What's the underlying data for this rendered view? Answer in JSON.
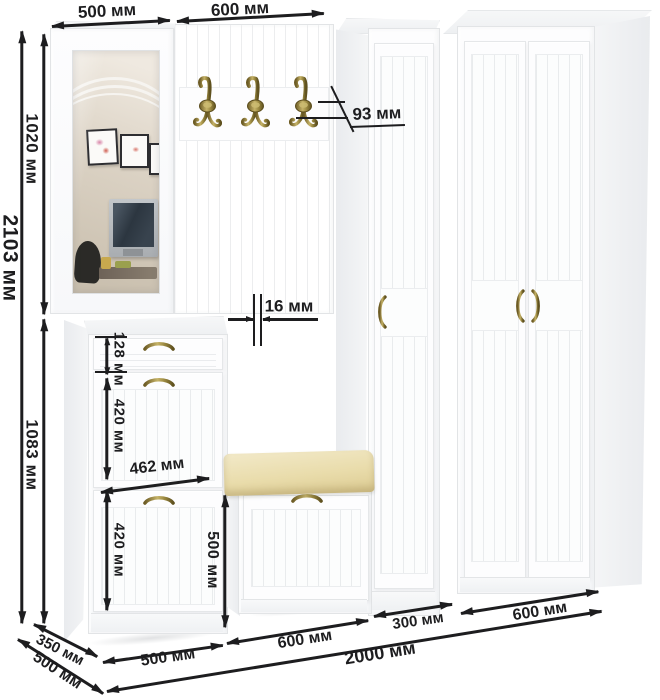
{
  "diagram": {
    "unit": "мм",
    "ink_color": "#1d1d1f",
    "brass_color": "#8d7a3c",
    "cushion_color": "#e9dcab",
    "furniture_color": "#fcfcfd"
  },
  "labels": {
    "mirror_width": "500 мм",
    "hook_panel_width": "600 мм",
    "total_height": "2103 мм",
    "upper_height": "1020 мм",
    "lower_height": "1083 мм",
    "hook_depth": "93 мм",
    "panel_thickness": "16 мм",
    "drawer_height": "128 мм",
    "upper_door_height": "420 мм",
    "chest_inner_width": "462 мм",
    "lower_door_height": "420 мм",
    "bench_height": "500 мм",
    "chest_depth": "350 мм",
    "unit_depth": "500 мм",
    "chest_width": "500 мм",
    "bench_width": "600 мм",
    "cabinet_width": "300 мм",
    "wardrobe_width": "600 мм",
    "total_width": "2000 мм"
  }
}
